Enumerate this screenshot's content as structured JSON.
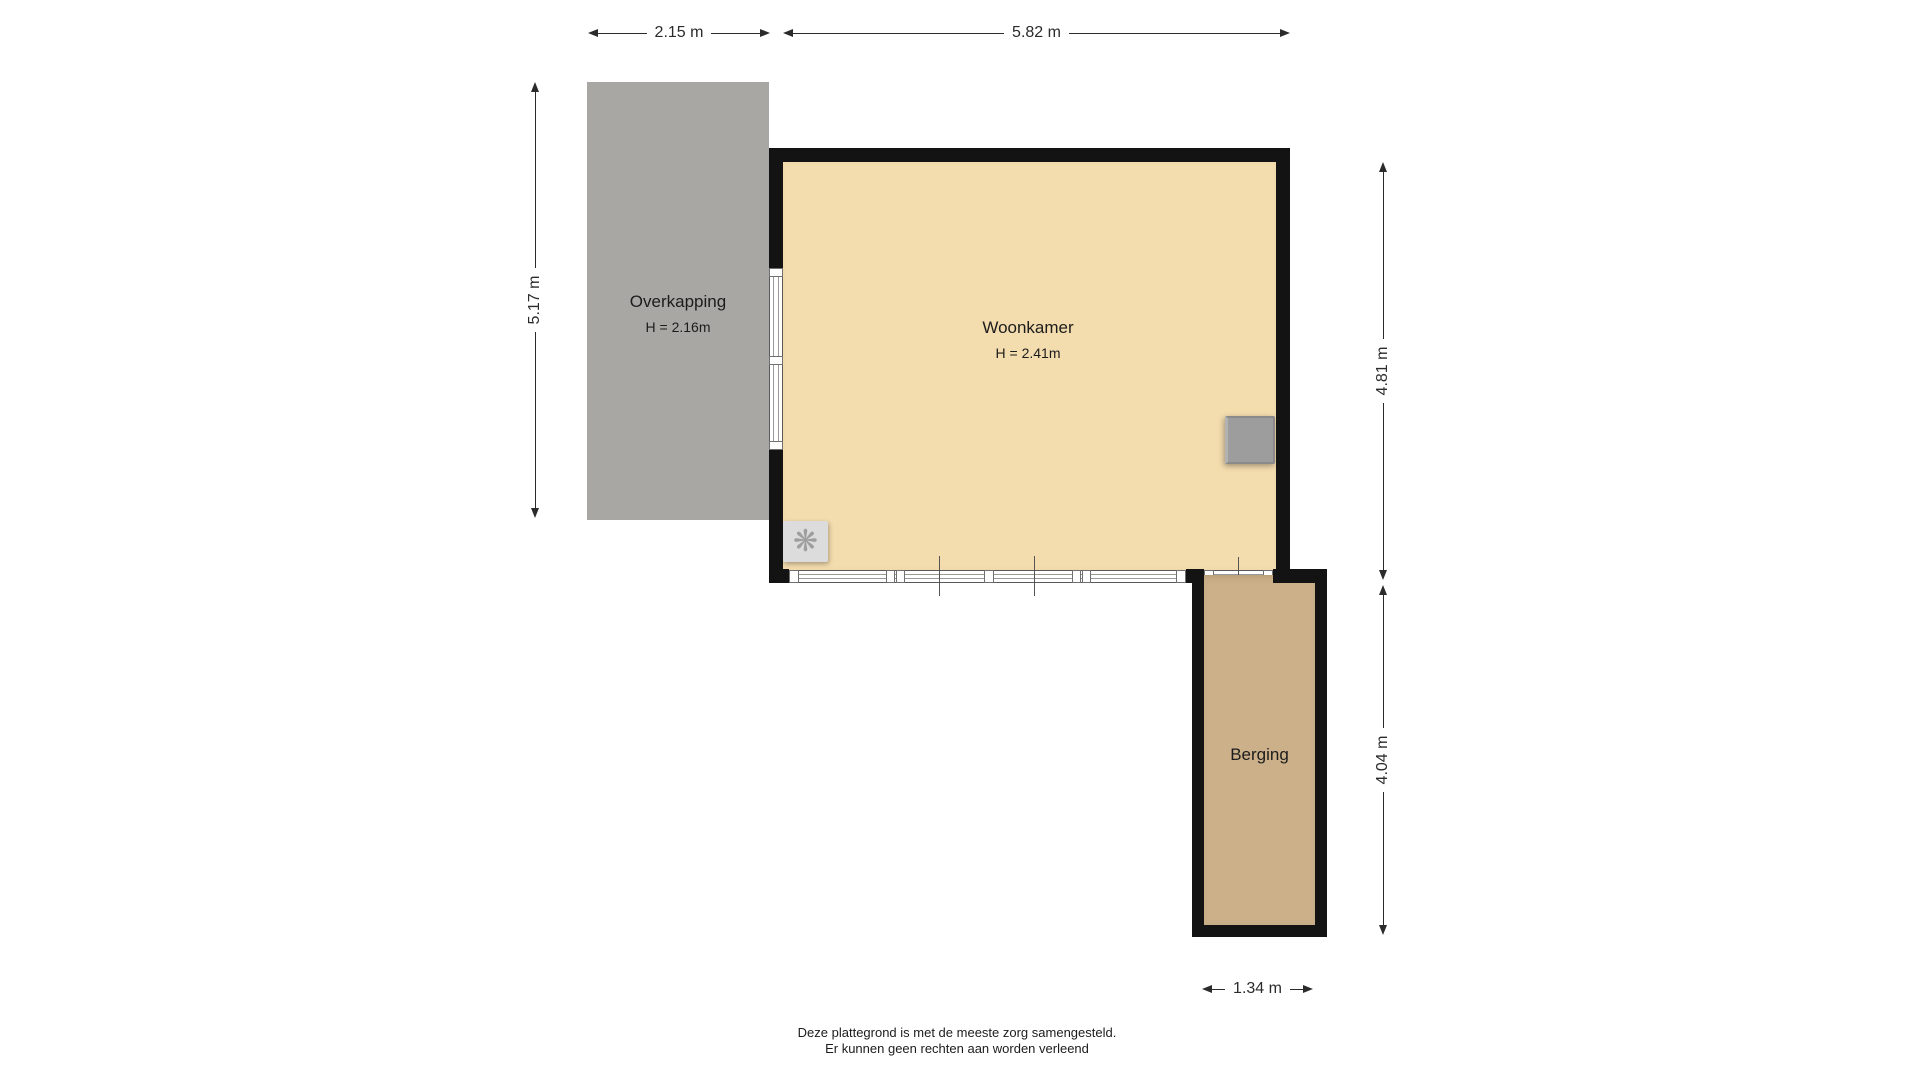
{
  "rooms": {
    "overkapping": {
      "label": "Overkapping",
      "height_label": "H = 2.16m"
    },
    "woonkamer": {
      "label": "Woonkamer",
      "height_label": "H = 2.41m"
    },
    "berging": {
      "label": "Berging"
    }
  },
  "dimensions": {
    "top_left": "2.15 m",
    "top_right": "5.82 m",
    "left": "5.17 m",
    "right_upper": "4.81 m",
    "right_lower": "4.04 m",
    "bottom": "1.34 m"
  },
  "footer": {
    "line1": "Deze plattegrond is met de meeste zorg samengesteld.",
    "line2": "Er kunnen geen rechten aan worden verleend"
  },
  "icons": {
    "ventilation": "❋"
  },
  "colors": {
    "wall": "#131313",
    "overkapping": "#a9a7a4",
    "woonkamer": "#f3dcae",
    "berging": "#cbb08a",
    "dimension": "#2b2b2b",
    "vent_bg": "#dcdcdc",
    "vent_glyph": "#9e9e9e",
    "appliance": "#9d9d9d"
  }
}
